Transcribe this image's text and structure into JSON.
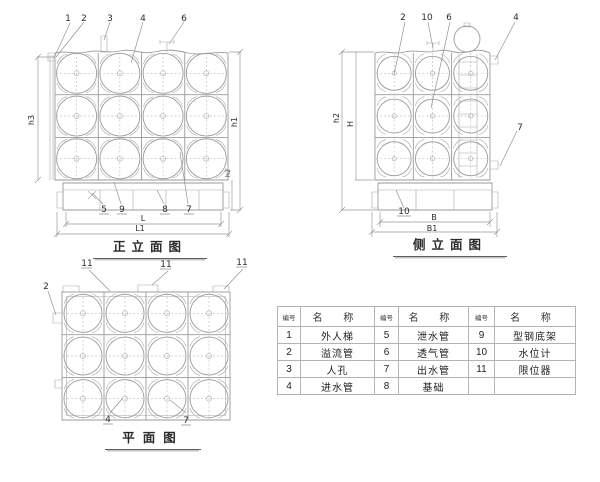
{
  "colors": {
    "line": "#9a9a9a",
    "text": "#2c2c2c"
  },
  "views": {
    "front": {
      "label": "正立面图",
      "callouts_top": [
        "1",
        "2",
        "3",
        "4",
        "6"
      ],
      "callouts_bottom": [
        "5",
        "9",
        "8",
        "7"
      ],
      "dims": {
        "left": "h3",
        "right": "h1",
        "right_lower": "h2",
        "bottom_inner": "L",
        "bottom_outer": "L1"
      }
    },
    "side": {
      "label": "侧立面图",
      "callouts_top": [
        "2",
        "10",
        "6",
        "4"
      ],
      "callout_right": "7",
      "callout_bottom": "10",
      "dims": {
        "left_outer": "h2",
        "left_inner": "H",
        "bottom_inner": "B",
        "bottom_outer": "B1"
      }
    },
    "plan": {
      "label": "平面图",
      "callouts_top": [
        "11",
        "11",
        "11"
      ],
      "callout_left": "2",
      "callouts_bottom": [
        "4",
        "7"
      ]
    }
  },
  "parts_table": {
    "headers": [
      "编号",
      "名 称"
    ],
    "rows": [
      [
        "1",
        "外人梯",
        "5",
        "泄水管",
        "9",
        "型钢底架"
      ],
      [
        "2",
        "溢流管",
        "6",
        "透气管",
        "10",
        "水位计"
      ],
      [
        "3",
        "人孔",
        "7",
        "出水管",
        "11",
        "限位器"
      ],
      [
        "4",
        "进水管",
        "8",
        "基础",
        "",
        ""
      ]
    ]
  }
}
